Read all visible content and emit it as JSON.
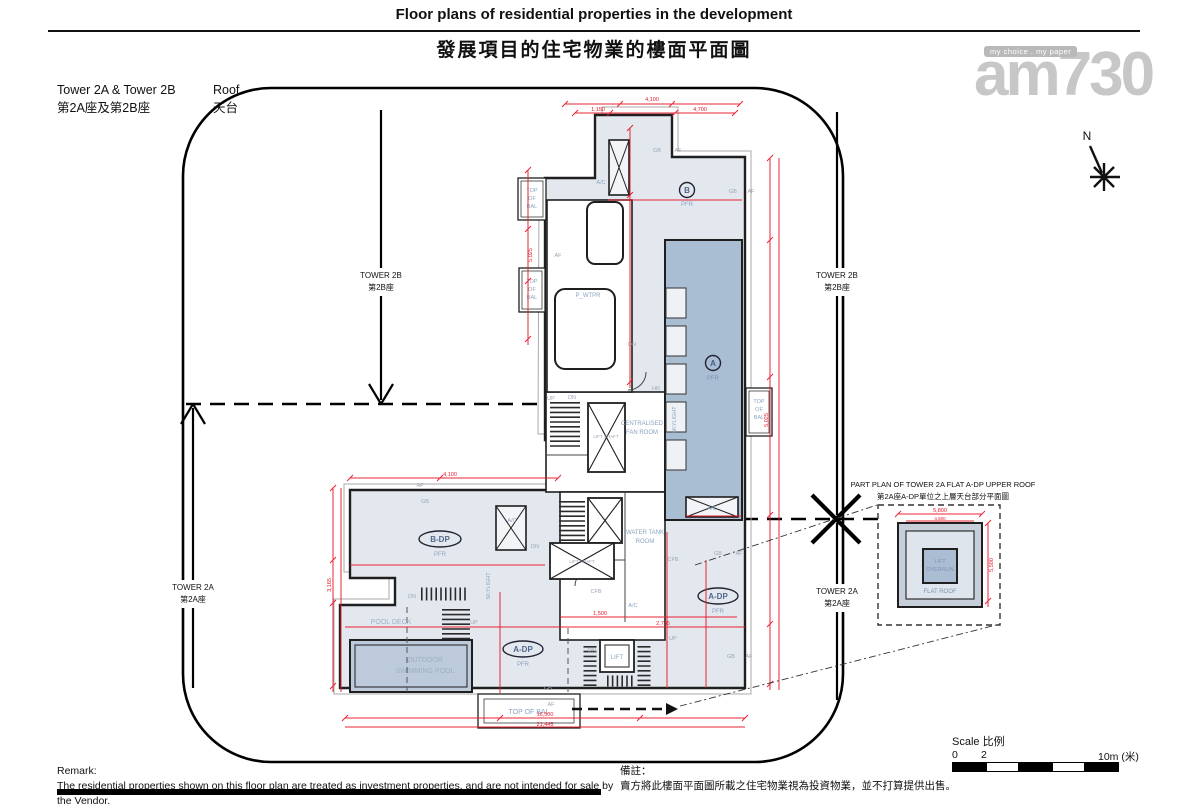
{
  "colors": {
    "dim_red": "#e8192c",
    "roof_light": "#e3e8ef",
    "roof_dark": "#a9bdd3",
    "pool_fill": "#bccadb",
    "label_blue": "#8ba4c0",
    "wall": "#1f1f1f",
    "watermark_gray": "#c7c7c7"
  },
  "title": {
    "en": "Floor plans of residential properties in the development",
    "zh": "發展項目的住宅物業的樓面平面圖"
  },
  "header": {
    "tower_en": "Tower 2A & Tower 2B",
    "tower_zh": "第2A座及第2B座",
    "floor_en": "Roof",
    "floor_zh": "天台"
  },
  "watermark": {
    "tagline": "my choice . my paper",
    "brand": "am730"
  },
  "compass": {
    "north": "N"
  },
  "plan": {
    "tower_2a_en": "TOWER 2A",
    "tower_2a_zh": "第2A座",
    "tower_2b_en": "TOWER 2B",
    "tower_2b_zh": "第2B座",
    "flat_a": "A",
    "flat_b": "B",
    "flat_a_dp": "A-DP",
    "flat_b_dp": "B-DP",
    "pfr": "PFR",
    "pool_deck": "POOL DECK",
    "pool_line1": "OUTDOOR",
    "pool_line2": "SWIMMING POOL",
    "top_of_bal": "TOP OF BAL",
    "top": "TOP",
    "of": "OF",
    "bal": "BAL",
    "p_wtpr": "P_WTPR",
    "fan_room_line1": "CENTRALISED",
    "fan_room_line2": "FAN ROOM",
    "water_tank_line1": "WATER TANK",
    "water_tank_line2": "ROOM",
    "lift_shaft": "LIFT SHAFT",
    "lift": "LIFT",
    "skylight": "SKYLIGHT",
    "ac": "A/C",
    "gb": "GB",
    "af": "AF",
    "dn": "DN",
    "up": "UP",
    "hr": "HR",
    "cfb": "CFB"
  },
  "part_plan": {
    "title_en": "PART PLAN OF TOWER 2A FLAT A-DP UPPER ROOF",
    "title_zh": "第2A座A-DP單位之上層天台部分平面圖",
    "lift_line1": "LIFT",
    "lift_line2": "OVERRUN",
    "flat_roof": "FLAT ROOF"
  },
  "scale_bar": {
    "label": "Scale 比例",
    "tick_0": "0",
    "tick_2": "2",
    "tick_10": "10m (米)"
  },
  "remark": {
    "en_title": "Remark:",
    "en_body": "The residential properties shown on this floor plan are treated as investment properties, and are not intended for sale by the Vendor.",
    "zh_title": "備註：",
    "zh_body": "賣方將此樓面平面圖所載之住宅物業視為投資物業，並不打算提供出售。"
  },
  "dims": [
    "4,100",
    "5,025",
    "2,850",
    "1,150",
    "4,700",
    "16,500",
    "21,445",
    "3,165",
    "1,500",
    "5,500",
    "4,625",
    "5,800",
    "4,500",
    "2,735"
  ]
}
